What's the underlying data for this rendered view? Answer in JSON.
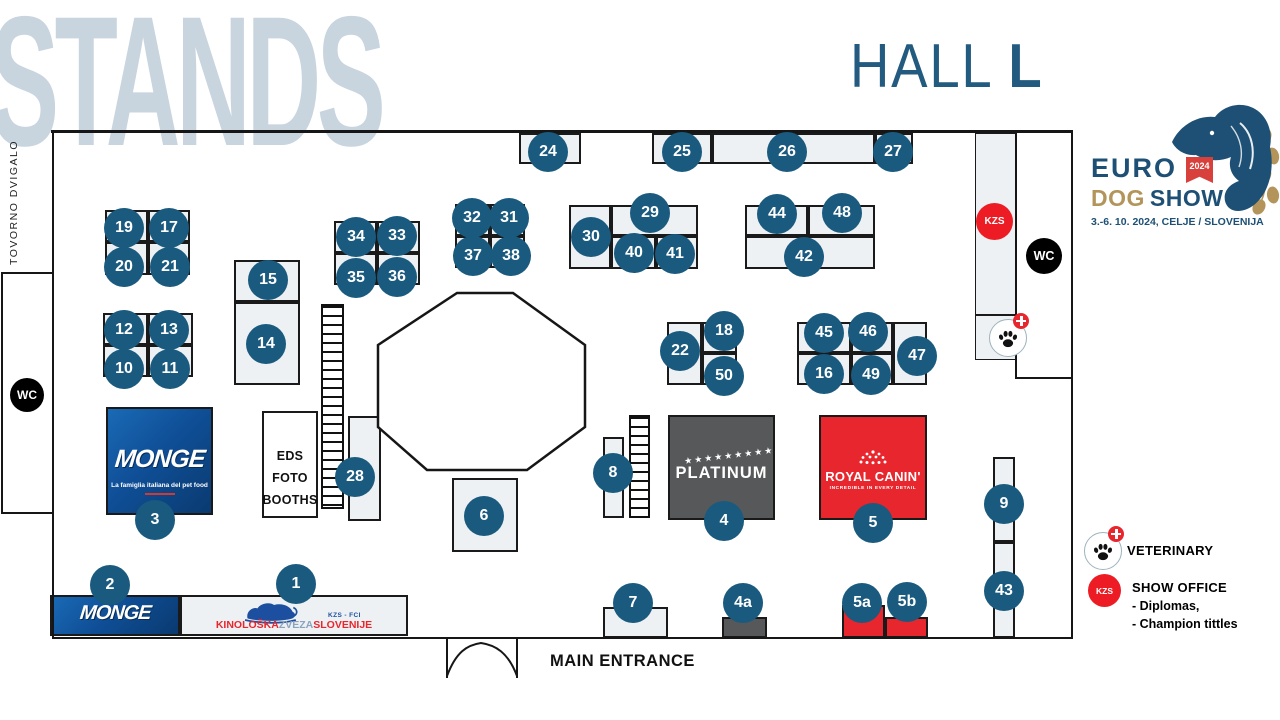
{
  "title_watermark": "STANDS",
  "hall_title": {
    "prefix": "HALL ",
    "letter": "L"
  },
  "logo": {
    "euro": "EURO",
    "year": "2024",
    "dog": "DOG",
    "show": "SHOW",
    "date": "3.-6. 10. 2024, CELJE / SLOVENIJA"
  },
  "labels": {
    "cargo_lift": "TOVORNO DVIGALO",
    "wc": "WC",
    "kzs": "KZS",
    "main_entrance": "MAIN ENTRANCE",
    "eds_lines": [
      "EDS",
      "FOTO",
      "BOOTHS"
    ]
  },
  "legend": {
    "veterinary": "VETERINARY",
    "show_office": "SHOW OFFICE",
    "details": [
      "- Diplomas,",
      "- Champion tittles"
    ]
  },
  "brands": {
    "monge": {
      "name": "MONGE",
      "tagline": "La famiglia italiana del pet food"
    },
    "platinum": {
      "name": "PLATINUM",
      "stars": "★★★★★★★★★"
    },
    "royal_canin": {
      "name": "ROYAL CANIN'",
      "tagline": "INCREDIBLE IN EVERY DETAIL"
    },
    "kzs_stand": {
      "federation": "KZS - FCI",
      "org_parts": [
        "KINOLOŠKA",
        "ZVEZA",
        "SLOVENIJE"
      ]
    }
  },
  "colors": {
    "badge_blue": "#1a5a7e",
    "navy": "#1d5074",
    "gold": "#b3955c",
    "stand_fill": "#eef1f3",
    "wall": "#161616",
    "red": "#e8262d",
    "kzs_red": "#ed1c24",
    "dark_gray": "#57585a",
    "watermark": "#c8d4de",
    "monge_blue": "#0f4f97"
  },
  "map": {
    "walls": [
      {
        "x": 51,
        "y": 130,
        "w": 1022,
        "h": 2.5
      },
      {
        "x": 51.5,
        "y": 130,
        "w": 2.5,
        "h": 508
      },
      {
        "x": 1070.5,
        "y": 130,
        "w": 2.5,
        "h": 509
      },
      {
        "x": 51.5,
        "y": 636.5,
        "w": 1021.5,
        "h": 2.5
      },
      {
        "x": 0.5,
        "y": 272,
        "w": 2,
        "h": 242
      },
      {
        "x": 0.5,
        "y": 272,
        "w": 53,
        "h": 2
      },
      {
        "x": 0.5,
        "y": 512,
        "w": 53,
        "h": 2
      },
      {
        "x": 1015,
        "y": 131,
        "w": 2,
        "h": 248
      },
      {
        "x": 1015,
        "y": 377,
        "w": 57,
        "h": 2
      }
    ],
    "stairs": [
      {
        "x": 321,
        "y": 304,
        "w": 23,
        "h": 205
      },
      {
        "x": 629,
        "y": 415,
        "w": 21,
        "h": 103
      }
    ],
    "units": [
      {
        "id": "24",
        "x": 519,
        "y": 133,
        "w": 62,
        "h": 31
      },
      {
        "id": "25",
        "x": 652,
        "y": 133,
        "w": 60,
        "h": 31
      },
      {
        "id": "26",
        "x": 712,
        "y": 133,
        "w": 163,
        "h": 31
      },
      {
        "id": "27",
        "x": 875,
        "y": 133,
        "w": 38,
        "h": 31
      },
      {
        "id": "19",
        "x": 105,
        "y": 210,
        "w": 43,
        "h": 32
      },
      {
        "id": "17",
        "x": 148,
        "y": 210,
        "w": 42,
        "h": 32
      },
      {
        "id": "20",
        "x": 105,
        "y": 242,
        "w": 43,
        "h": 33
      },
      {
        "id": "21",
        "x": 148,
        "y": 242,
        "w": 42,
        "h": 33
      },
      {
        "id": "12",
        "x": 103,
        "y": 313,
        "w": 45,
        "h": 32
      },
      {
        "id": "13",
        "x": 148,
        "y": 313,
        "w": 45,
        "h": 32
      },
      {
        "id": "10",
        "x": 103,
        "y": 345,
        "w": 45,
        "h": 32
      },
      {
        "id": "11",
        "x": 148,
        "y": 345,
        "w": 45,
        "h": 32
      },
      {
        "id": "15",
        "x": 234,
        "y": 260,
        "w": 66,
        "h": 42
      },
      {
        "id": "14",
        "x": 234,
        "y": 302,
        "w": 66,
        "h": 83
      },
      {
        "id": "34",
        "x": 334,
        "y": 221,
        "w": 43,
        "h": 32
      },
      {
        "id": "33",
        "x": 377,
        "y": 221,
        "w": 43,
        "h": 32
      },
      {
        "id": "35",
        "x": 334,
        "y": 253,
        "w": 43,
        "h": 32
      },
      {
        "id": "36",
        "x": 377,
        "y": 253,
        "w": 43,
        "h": 32
      },
      {
        "id": "32",
        "x": 455,
        "y": 204,
        "w": 35,
        "h": 32
      },
      {
        "id": "31",
        "x": 490,
        "y": 204,
        "w": 35,
        "h": 32
      },
      {
        "id": "37",
        "x": 455,
        "y": 236,
        "w": 35,
        "h": 32
      },
      {
        "id": "38",
        "x": 490,
        "y": 236,
        "w": 35,
        "h": 32
      },
      {
        "id": "30",
        "x": 569,
        "y": 205,
        "w": 42,
        "h": 64
      },
      {
        "id": "29",
        "x": 611,
        "y": 205,
        "w": 87,
        "h": 31
      },
      {
        "id": "40",
        "x": 611,
        "y": 236,
        "w": 45,
        "h": 33
      },
      {
        "id": "41",
        "x": 656,
        "y": 236,
        "w": 42,
        "h": 33
      },
      {
        "id": "44",
        "x": 745,
        "y": 205,
        "w": 63,
        "h": 31
      },
      {
        "id": "48",
        "x": 808,
        "y": 205,
        "w": 67,
        "h": 31
      },
      {
        "id": "42",
        "x": 745,
        "y": 236,
        "w": 130,
        "h": 33
      },
      {
        "id": "22",
        "x": 667,
        "y": 322,
        "w": 35,
        "h": 63
      },
      {
        "id": "18",
        "x": 702,
        "y": 322,
        "w": 35,
        "h": 31
      },
      {
        "id": "50",
        "x": 702,
        "y": 353,
        "w": 35,
        "h": 32
      },
      {
        "id": "45",
        "x": 797,
        "y": 322,
        "w": 54,
        "h": 31
      },
      {
        "id": "46",
        "x": 851,
        "y": 322,
        "w": 42,
        "h": 31
      },
      {
        "id": "16",
        "x": 797,
        "y": 353,
        "w": 54,
        "h": 32
      },
      {
        "id": "49",
        "x": 851,
        "y": 353,
        "w": 42,
        "h": 32
      },
      {
        "id": "47",
        "x": 893,
        "y": 322,
        "w": 34,
        "h": 63
      },
      {
        "id": "28",
        "x": 348,
        "y": 416,
        "w": 33,
        "h": 105
      },
      {
        "id": "8",
        "x": 603,
        "y": 437,
        "w": 21,
        "h": 81
      },
      {
        "id": "6",
        "x": 452,
        "y": 478,
        "w": 66,
        "h": 74
      },
      {
        "id": "7",
        "x": 603,
        "y": 607,
        "w": 65,
        "h": 31
      },
      {
        "id": "9",
        "x": 993,
        "y": 457,
        "w": 22,
        "h": 85
      },
      {
        "id": "43",
        "x": 993,
        "y": 542,
        "w": 22,
        "h": 96
      },
      {
        "id": "kzs-corridor",
        "kind": "thin",
        "x": 975,
        "y": 133,
        "w": 41,
        "h": 182
      },
      {
        "id": "vet-box",
        "kind": "thin",
        "x": 975,
        "y": 315,
        "w": 41,
        "h": 45
      },
      {
        "id": "eds",
        "kind": "white",
        "x": 262,
        "y": 411,
        "w": 56,
        "h": 107
      },
      {
        "id": "4a",
        "kind": "dark",
        "x": 722,
        "y": 617,
        "w": 45,
        "h": 21
      },
      {
        "id": "5a",
        "kind": "red",
        "x": 842,
        "y": 605,
        "w": 43,
        "h": 33
      },
      {
        "id": "5b",
        "kind": "red",
        "x": 885,
        "y": 617,
        "w": 43,
        "h": 21
      }
    ],
    "badges": [
      {
        "label": "24",
        "x": 548,
        "y": 152
      },
      {
        "label": "25",
        "x": 682,
        "y": 152
      },
      {
        "label": "26",
        "x": 787,
        "y": 152
      },
      {
        "label": "27",
        "x": 893,
        "y": 152
      },
      {
        "label": "19",
        "x": 124,
        "y": 228
      },
      {
        "label": "17",
        "x": 169,
        "y": 228
      },
      {
        "label": "20",
        "x": 124,
        "y": 267
      },
      {
        "label": "21",
        "x": 170,
        "y": 267
      },
      {
        "label": "12",
        "x": 124,
        "y": 330
      },
      {
        "label": "13",
        "x": 169,
        "y": 330
      },
      {
        "label": "10",
        "x": 124,
        "y": 369
      },
      {
        "label": "11",
        "x": 170,
        "y": 369
      },
      {
        "label": "15",
        "x": 268,
        "y": 280
      },
      {
        "label": "14",
        "x": 266,
        "y": 344
      },
      {
        "label": "34",
        "x": 356,
        "y": 237
      },
      {
        "label": "33",
        "x": 397,
        "y": 236
      },
      {
        "label": "35",
        "x": 356,
        "y": 278
      },
      {
        "label": "36",
        "x": 397,
        "y": 277
      },
      {
        "label": "32",
        "x": 472,
        "y": 218
      },
      {
        "label": "31",
        "x": 509,
        "y": 218
      },
      {
        "label": "37",
        "x": 473,
        "y": 256
      },
      {
        "label": "38",
        "x": 511,
        "y": 256
      },
      {
        "label": "30",
        "x": 591,
        "y": 237
      },
      {
        "label": "29",
        "x": 650,
        "y": 213
      },
      {
        "label": "40",
        "x": 634,
        "y": 253
      },
      {
        "label": "41",
        "x": 675,
        "y": 254
      },
      {
        "label": "44",
        "x": 777,
        "y": 214
      },
      {
        "label": "48",
        "x": 842,
        "y": 213
      },
      {
        "label": "42",
        "x": 804,
        "y": 257
      },
      {
        "label": "22",
        "x": 680,
        "y": 351
      },
      {
        "label": "18",
        "x": 724,
        "y": 331
      },
      {
        "label": "50",
        "x": 724,
        "y": 376
      },
      {
        "label": "45",
        "x": 824,
        "y": 333
      },
      {
        "label": "46",
        "x": 868,
        "y": 332
      },
      {
        "label": "16",
        "x": 824,
        "y": 374
      },
      {
        "label": "49",
        "x": 871,
        "y": 375
      },
      {
        "label": "47",
        "x": 917,
        "y": 356
      },
      {
        "label": "28",
        "x": 355,
        "y": 477
      },
      {
        "label": "8",
        "x": 613,
        "y": 473
      },
      {
        "label": "6",
        "x": 484,
        "y": 516
      },
      {
        "label": "9",
        "x": 1004,
        "y": 504
      },
      {
        "label": "43",
        "x": 1004,
        "y": 591
      },
      {
        "label": "3",
        "x": 155,
        "y": 520
      },
      {
        "label": "4",
        "x": 724,
        "y": 521
      },
      {
        "label": "5",
        "x": 873,
        "y": 523
      },
      {
        "label": "2",
        "x": 110,
        "y": 585
      },
      {
        "label": "1",
        "x": 296,
        "y": 584
      },
      {
        "label": "7",
        "x": 633,
        "y": 603
      },
      {
        "label": "4a",
        "x": 743,
        "y": 603
      },
      {
        "label": "5a",
        "x": 862,
        "y": 603
      },
      {
        "label": "5b",
        "x": 907,
        "y": 602
      }
    ]
  }
}
